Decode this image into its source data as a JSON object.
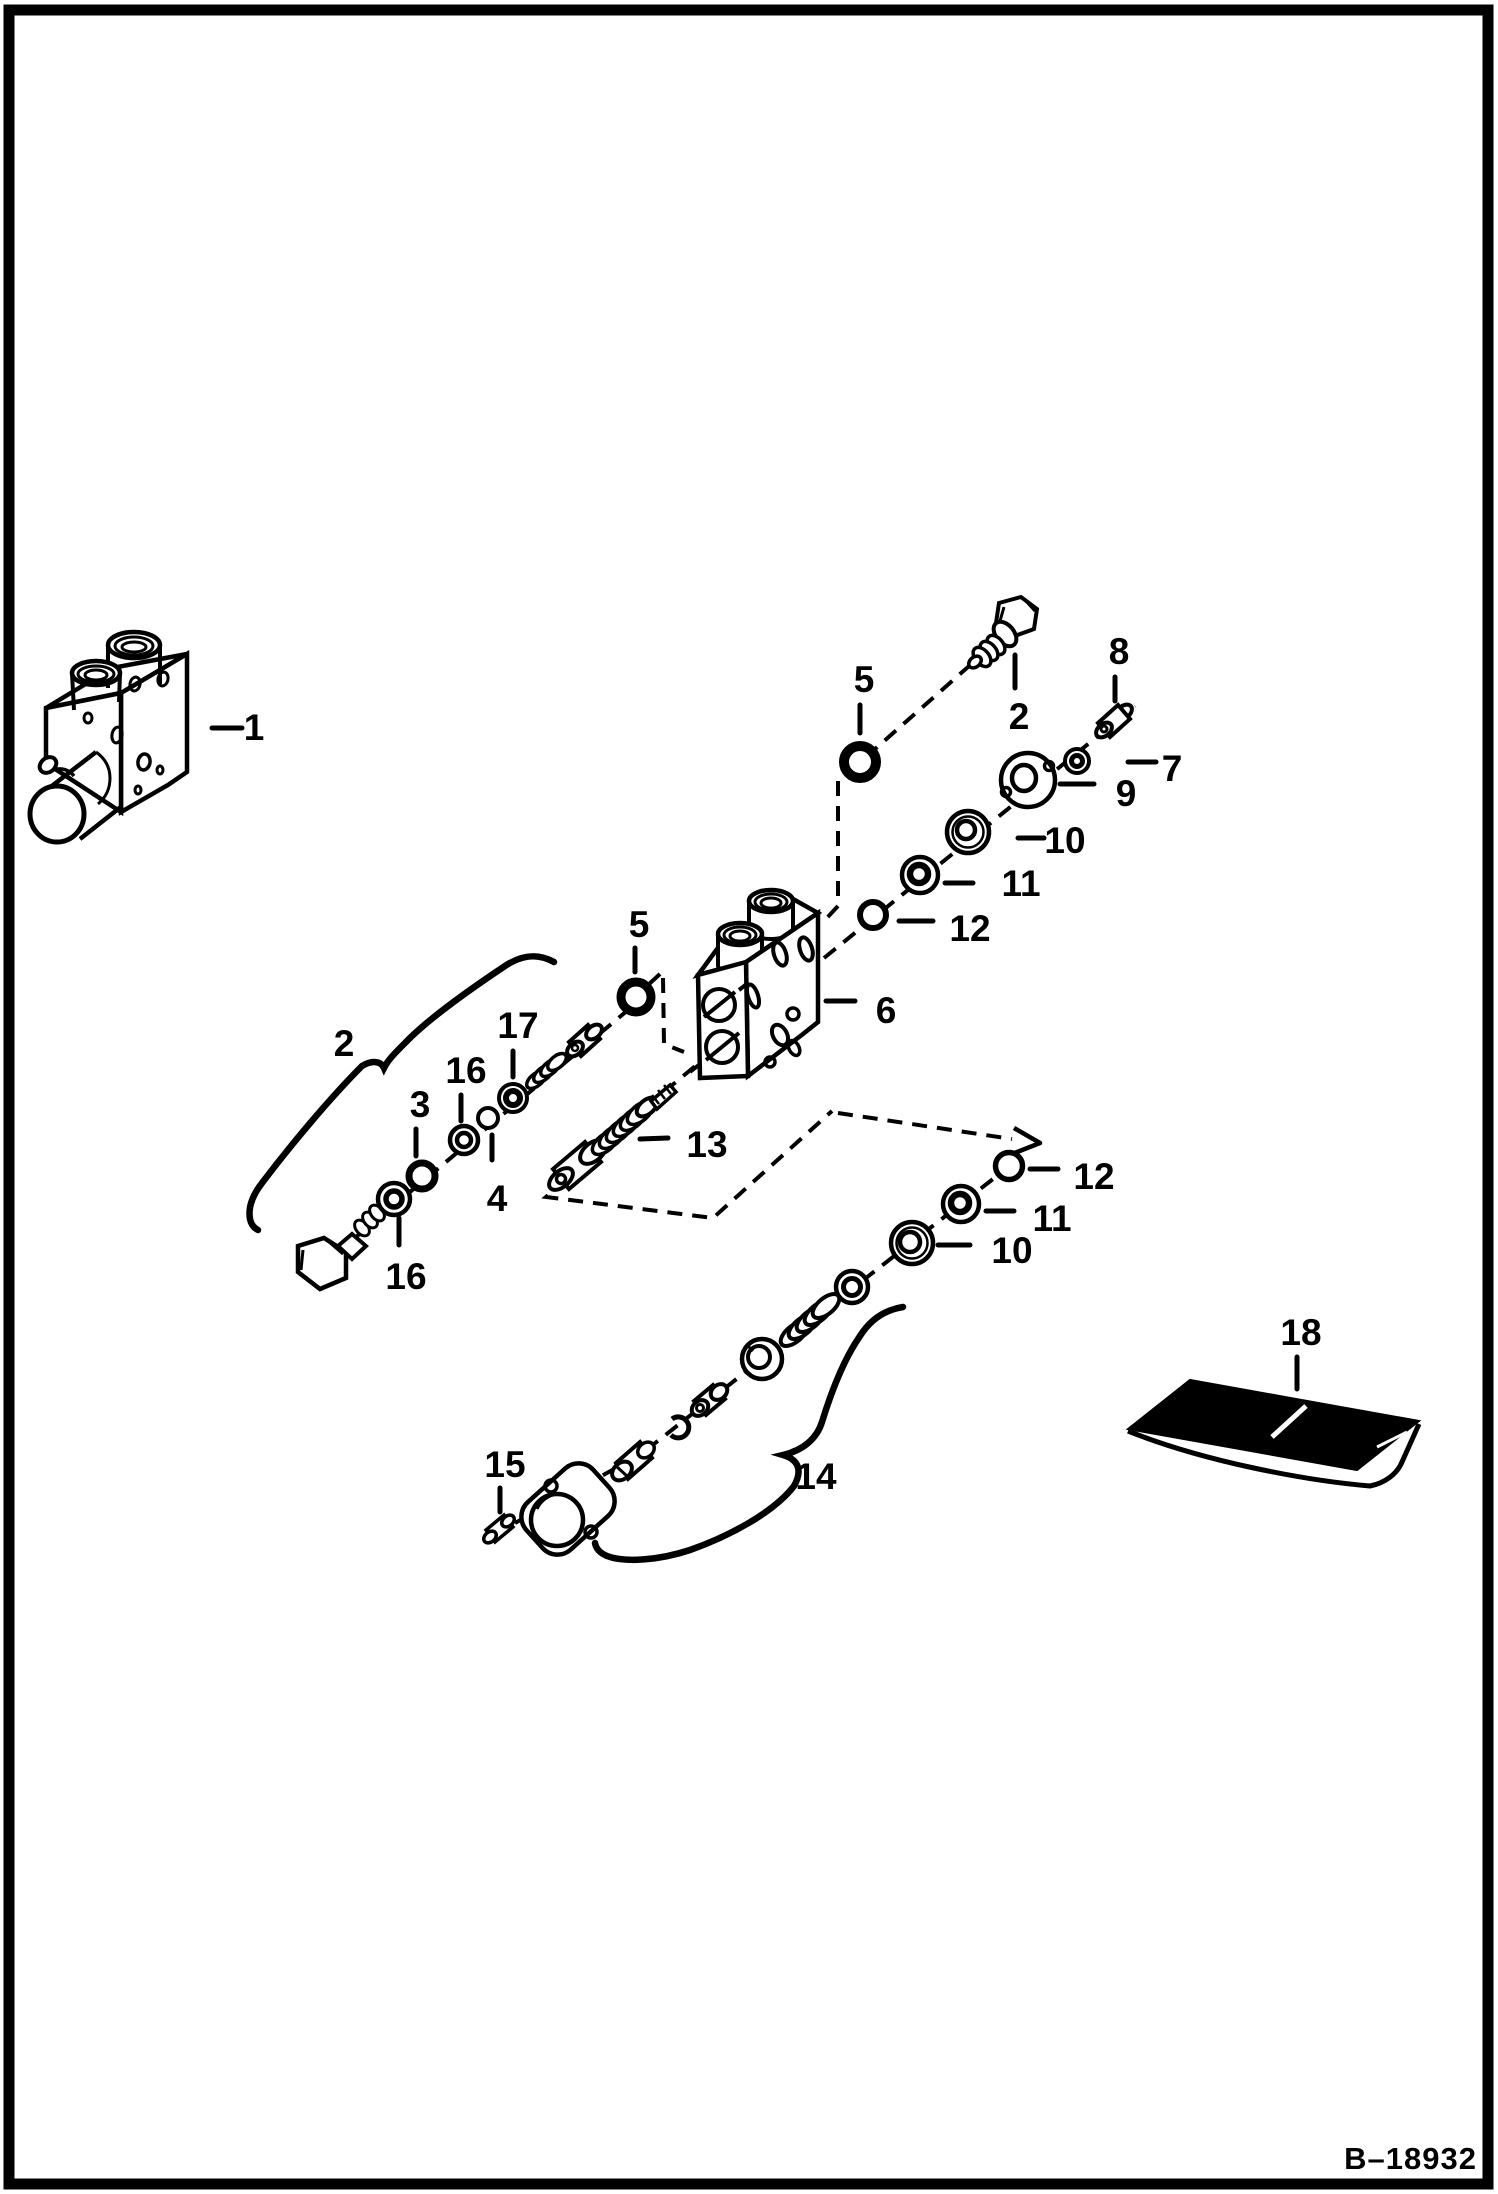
{
  "page": {
    "background": "#ffffff",
    "line_color": "#000000",
    "figure_code": "B–18932"
  },
  "labels": {
    "n1": "1",
    "n2": "2",
    "n3": "3",
    "n4": "4",
    "n5": "5",
    "n6": "6",
    "n7": "7",
    "n8": "8",
    "n9": "9",
    "n10": "10",
    "n11": "11",
    "n12": "12",
    "n13": "13",
    "n14": "14",
    "n15": "15",
    "n16": "16",
    "n17": "17",
    "n18": "18"
  }
}
